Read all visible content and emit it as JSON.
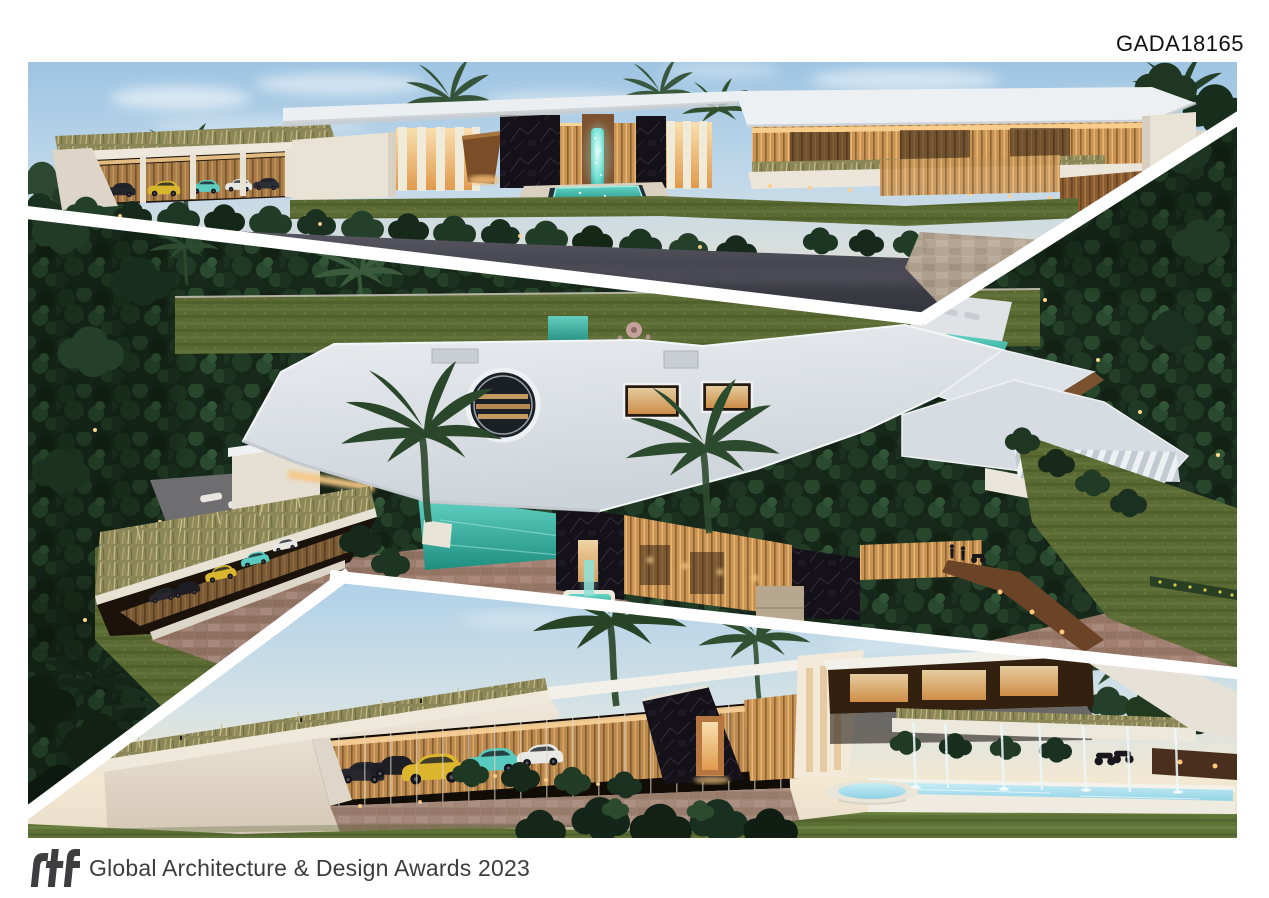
{
  "page": {
    "background": "#ffffff"
  },
  "header": {
    "submission_code": "GADA18165"
  },
  "footer": {
    "logo_text": "rtf",
    "award_text": "Global Architecture & Design Awards 2023"
  },
  "collage": {
    "renders": [
      {
        "id": "front-elevation",
        "subject": "Front elevation of a modern villa at dusk: green-roof carport with sports cars, black marble walls, glowing turquoise water sculpture, cantilevered white roofs and palm trees"
      },
      {
        "id": "aerial-view",
        "subject": "Aerial dusk view: sculptural white roof with circular skylight pierced by twin palms, turquoise pools, stone driveway, jungle garden and lawn"
      },
      {
        "id": "entrance-view",
        "subject": "Entrance view at dusk: glass carport with yellow and teal sports cars, marble pivot-door entry, cantilevered canopy and long fountain pool with water jets"
      }
    ],
    "palette": {
      "sky_blue": "#aed0e8",
      "horizon_warm": "#f3e8d2",
      "foliage_dark": "#16281a",
      "lawn_green": "#5a6a32",
      "roof_white": "#e8ebee",
      "wall_cream": "#efe8da",
      "warm_light": "#f2c27c",
      "wood_brown": "#a06c3f",
      "marble_black": "#141118",
      "pool_teal": "#2aa395",
      "pool_light_blue": "#9fd8e8",
      "asphalt_gray": "#3a3a43",
      "stone_beige": "#b3a391",
      "car_yellow": "#dcb52e",
      "car_teal": "#58cabe",
      "divider_white": "#ffffff"
    }
  }
}
